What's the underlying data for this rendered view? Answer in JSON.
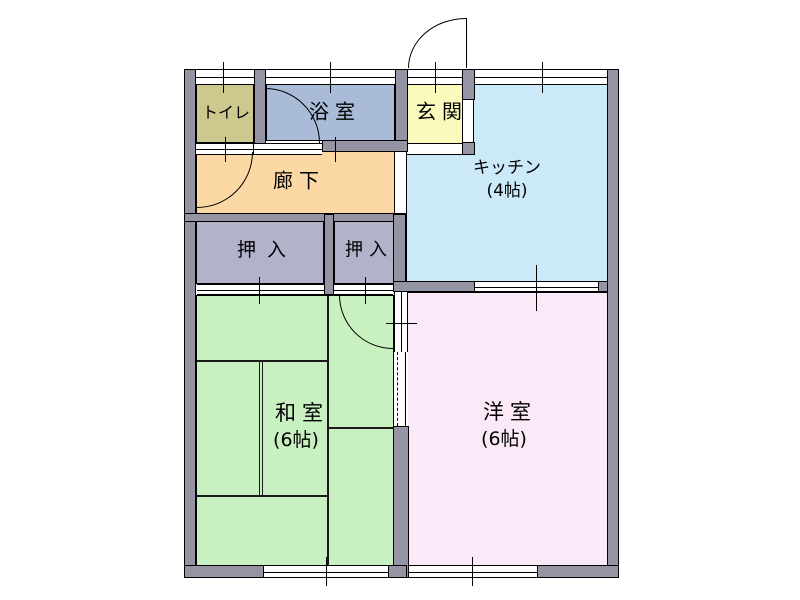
{
  "plan": {
    "type": "japanese-apartment-floor-plan",
    "rooms": {
      "toilet": {
        "label": "トイレ"
      },
      "bath": {
        "label": "浴室"
      },
      "entrance": {
        "label": "玄関"
      },
      "kitchen": {
        "label": "キッチン",
        "size": "(4帖)"
      },
      "hallway": {
        "label": "廊下"
      },
      "closet1": {
        "label": "押入"
      },
      "closet2": {
        "label": "押入"
      },
      "washitsu": {
        "label": "和室",
        "size": "(6帖)"
      },
      "yoshitsu": {
        "label": "洋室",
        "size": "(6帖)"
      }
    },
    "colors": {
      "toilet": "#cdc88e",
      "bath": "#a9bbd7",
      "entrance": "#fafabc",
      "kitchen": "#cbe9f8",
      "hallway": "#fbd8a4",
      "closet": "#b2b2ca",
      "washitsu": "#c8f0c0",
      "yoshitsu": "#fce9f8",
      "wall": "#9594a5",
      "line": "#000000",
      "background": "#ffffff"
    }
  }
}
